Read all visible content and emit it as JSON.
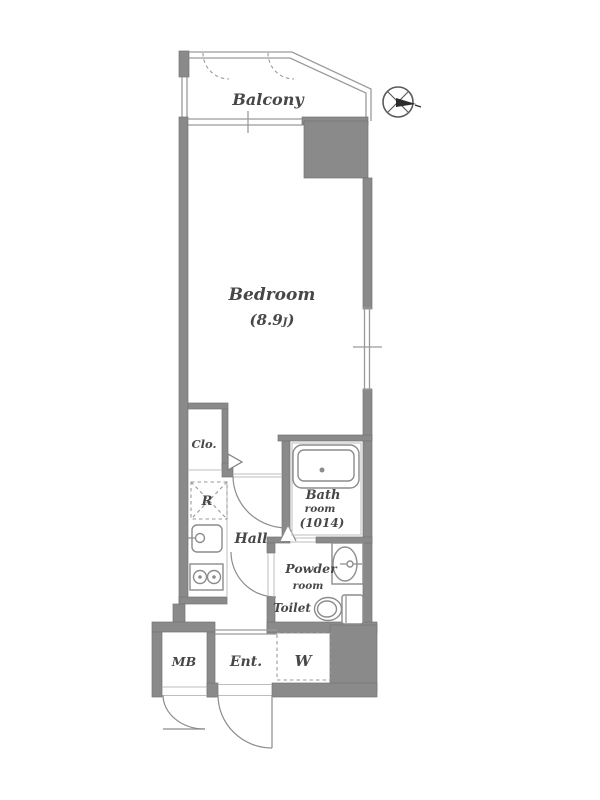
{
  "colors": {
    "wall": "#8a8a8a",
    "wall_edge": "#757575",
    "line": "#9a9a9a",
    "fixture": "#8c8c8c",
    "text": "#474747"
  },
  "rooms": {
    "balcony": {
      "label": "Balcony"
    },
    "bedroom": {
      "label": "Bedroom",
      "size_open": "(8.9",
      "size_unit": "J",
      "size_close": ")"
    },
    "closet": {
      "label": "Clo."
    },
    "refrigerator": {
      "label": "R"
    },
    "hall": {
      "label": "Hall"
    },
    "bathroom": {
      "line1": "Bath",
      "line2": "room",
      "line3": "(1014)"
    },
    "powder_room": {
      "line1": "Powder",
      "line2": "room"
    },
    "toilet": {
      "label": "Toilet"
    },
    "meter_box": {
      "label": "MB"
    },
    "entrance": {
      "label": "Ent."
    },
    "washer": {
      "label": "W"
    }
  }
}
